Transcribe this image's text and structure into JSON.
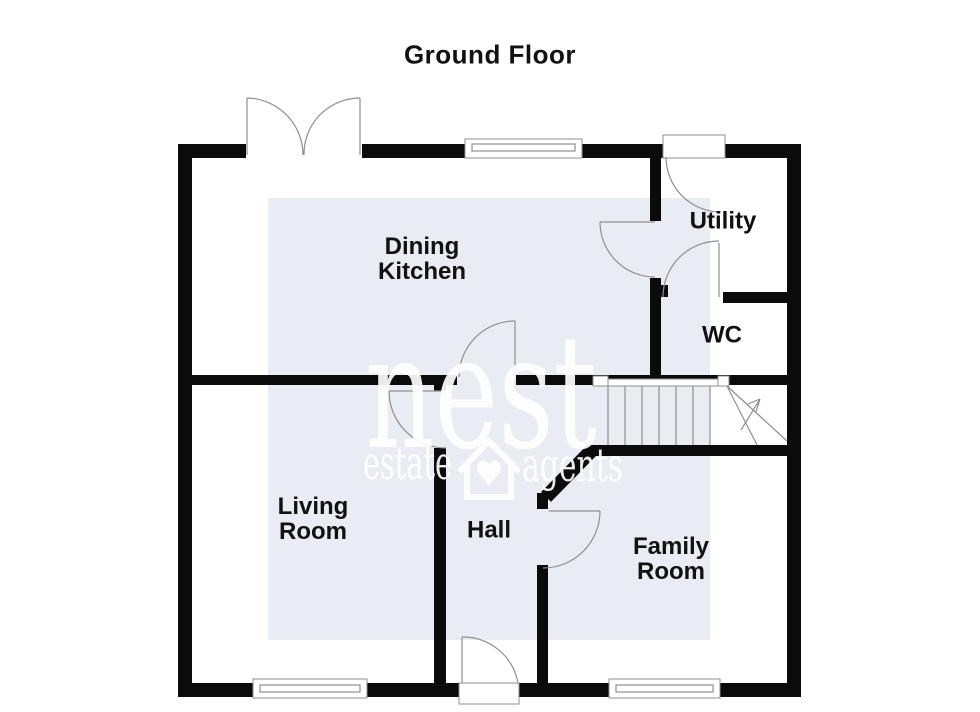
{
  "title": "Ground Floor",
  "rooms": [
    {
      "id": "dining-kitchen",
      "label": "Dining\nKitchen"
    },
    {
      "id": "utility",
      "label": "Utility"
    },
    {
      "id": "wc",
      "label": "WC"
    },
    {
      "id": "living-room",
      "label": "Living\nRoom"
    },
    {
      "id": "hall",
      "label": "Hall"
    },
    {
      "id": "family-room",
      "label": "Family\nRoom"
    }
  ],
  "stairs": {
    "direction_symbol": "up-arrow"
  },
  "watermark": {
    "brand": "nest",
    "word_left": "estate",
    "word_right": "agents",
    "logo": "house-heart-icon"
  },
  "colors": {
    "wall": "#0b0b0b",
    "line": "#8f8f8f",
    "watermark_box": "#e9ecf2",
    "watermark_text": "#ffffff",
    "label_text": "#111111",
    "background": "#ffffff"
  }
}
